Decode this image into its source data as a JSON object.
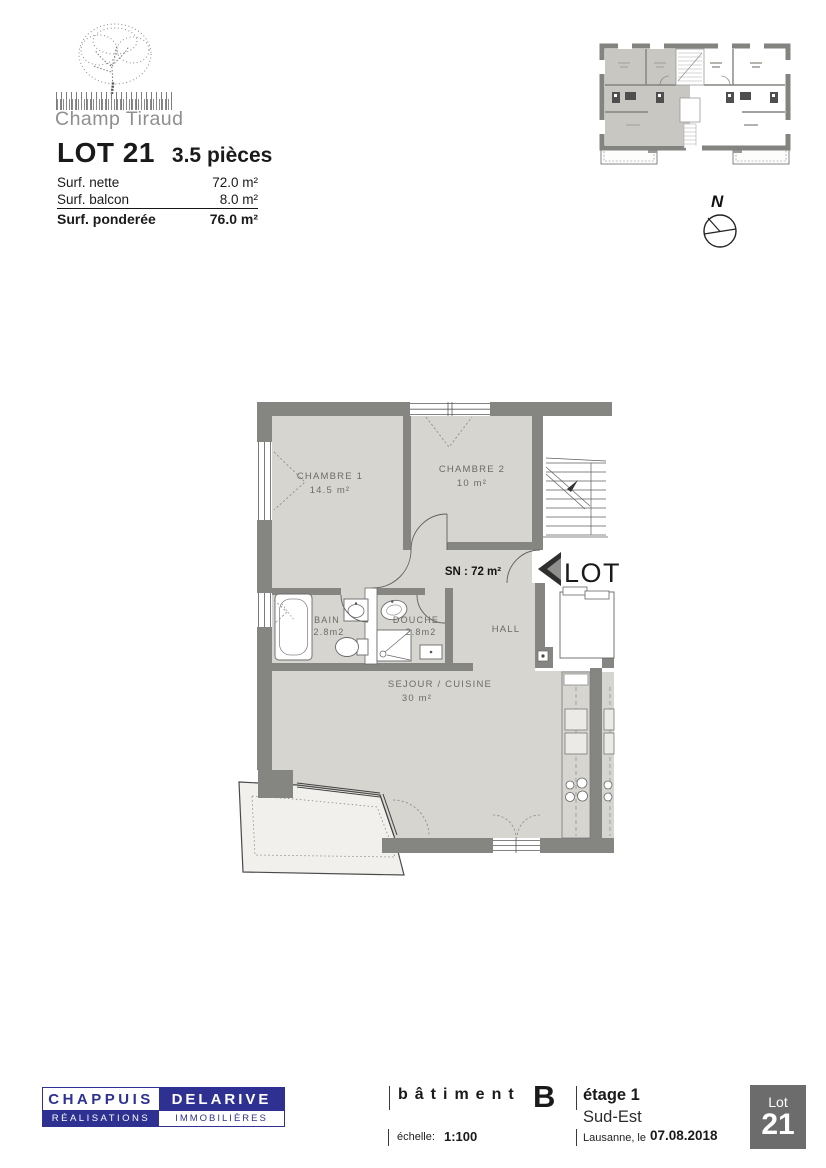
{
  "brand": {
    "name": "Champ Tiraud"
  },
  "lot": {
    "title": "LOT 21",
    "type": "3.5 pièces"
  },
  "surfaces": {
    "rows": [
      {
        "label": "Surf. nette",
        "value": "72.0 m²"
      },
      {
        "label": "Surf. balcon",
        "value": "8.0 m²"
      },
      {
        "label": "Surf. ponderée",
        "value": "76.0 m²"
      }
    ]
  },
  "compass": {
    "north": "N"
  },
  "plan": {
    "chambre1": {
      "name": "CHAMBRE 1",
      "area": "14.5 m²"
    },
    "chambre2": {
      "name": "CHAMBRE 2",
      "area": "10 m²"
    },
    "bain": {
      "name": "BAIN",
      "area": "2.8m2"
    },
    "douche": {
      "name": "DOUCHE",
      "area": "2.8m2"
    },
    "hall": {
      "name": "HALL"
    },
    "sejour": {
      "name": "SEJOUR / CUISINE",
      "area": "30 m²"
    },
    "surface_note": "SN : 72 m²",
    "lot_flag": "LOT 21"
  },
  "footer": {
    "company": {
      "top_left": "CHAPPUIS",
      "top_right": "DELARIVE",
      "bottom_left": "RÉALISATIONS",
      "bottom_right": "IMMOBILIÈRES"
    },
    "building": {
      "label": "bâtiment",
      "value": "B"
    },
    "floor": {
      "label": "étage 1",
      "orientation": "Sud-Est"
    },
    "scale": {
      "label": "échelle:",
      "value": "1:100"
    },
    "date": {
      "label": "Lausanne, le",
      "value": "07.08.2018"
    },
    "badge": {
      "label": "Lot",
      "number": "21"
    }
  },
  "colors": {
    "brand_blue": "#2e3192",
    "wall_gray": "#858581",
    "room_fill": "#d7d5cf",
    "badge_gray": "#6c6c6c"
  }
}
